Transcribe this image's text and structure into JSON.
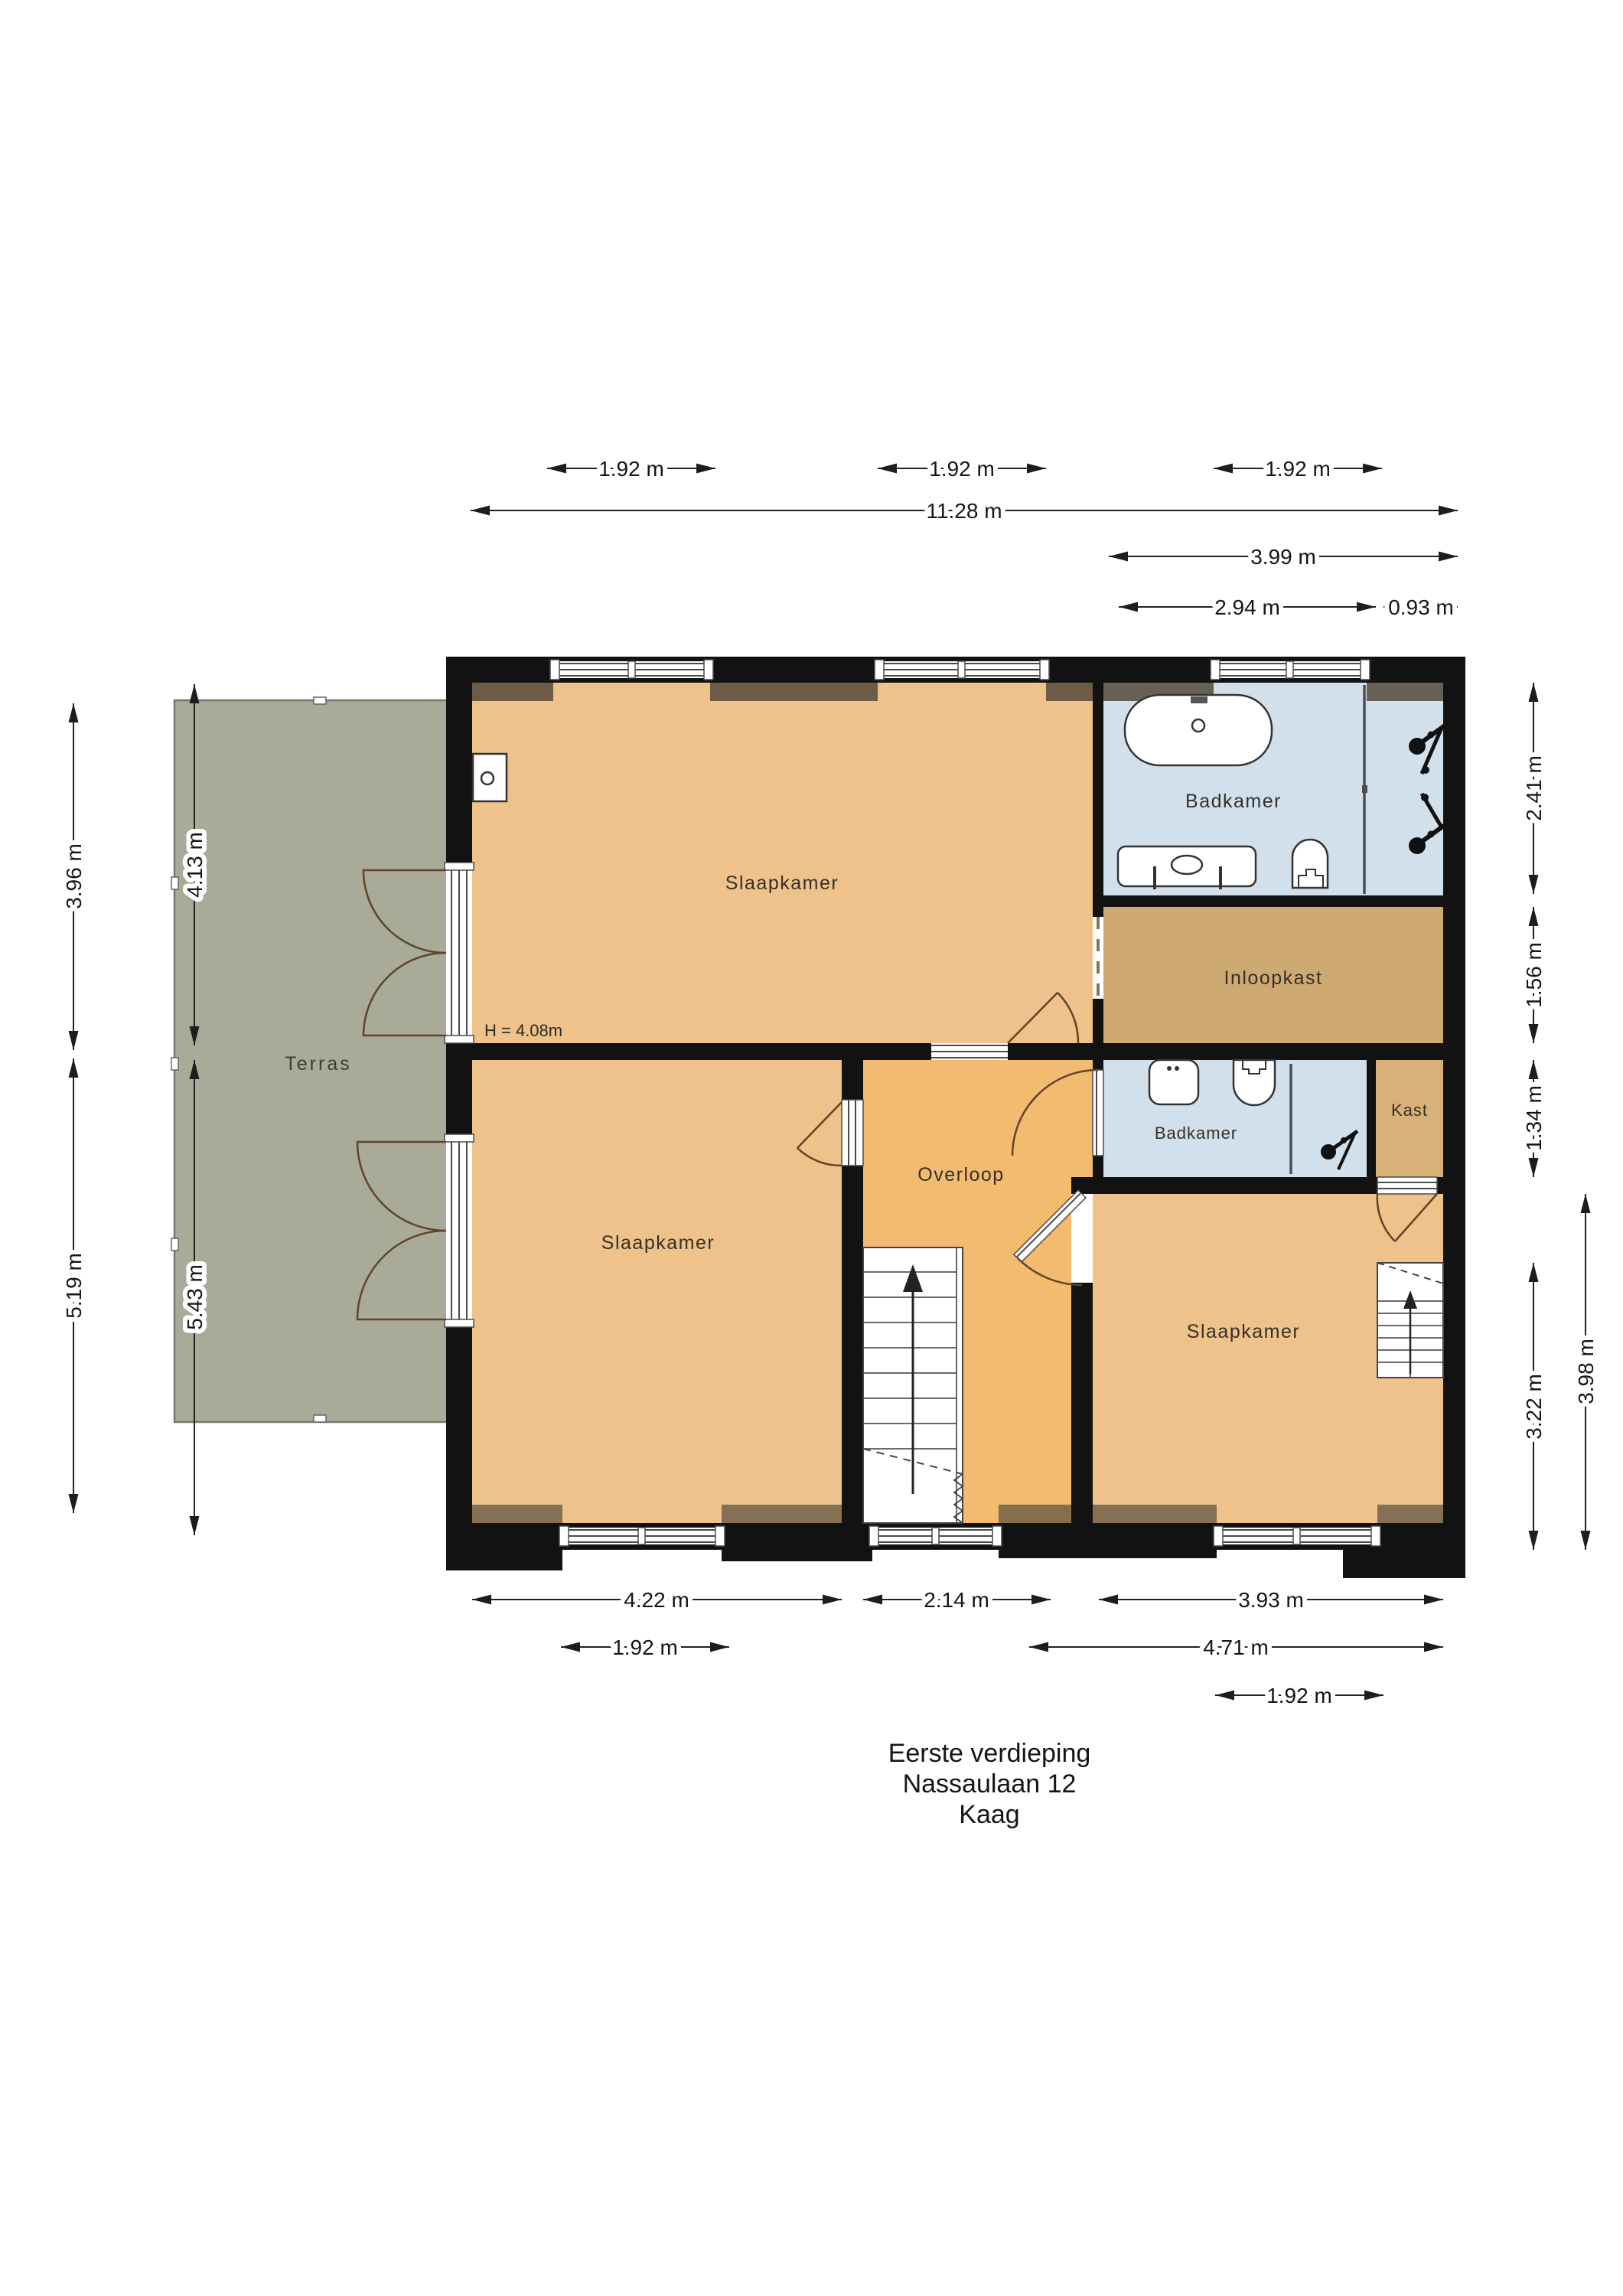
{
  "title": {
    "line1": "Eerste verdieping",
    "line2": "Nassaulaan 12",
    "line3": "Kaag"
  },
  "rooms": {
    "slaapkamer_top": "Slaapkamer",
    "badkamer_main": "Badkamer",
    "inloopkast": "Inloopkast",
    "badkamer_small": "Badkamer",
    "kast": "Kast",
    "overloop": "Overloop",
    "slaapkamer_left": "Slaapkamer",
    "slaapkamer_right": "Slaapkamer",
    "terras": "Terras",
    "height_note": "H = 4.08m"
  },
  "dimensions": {
    "top": [
      "1.92 m",
      "1.92 m",
      "1.92 m",
      "11.28 m",
      "3.99 m",
      "2.94 m",
      "0.93 m"
    ],
    "bottom": [
      "4.22 m",
      "2.14 m",
      "3.93 m",
      "1.92 m",
      "4.71 m",
      "1.92 m"
    ],
    "left": [
      "3.96 m",
      "4.13 m",
      "5.19 m",
      "5.43 m"
    ],
    "right": [
      "2.41 m",
      "1.56 m",
      "1.34 m",
      "3.22 m",
      "3.98 m"
    ]
  },
  "colors": {
    "bedroom_floor": "#eec28a",
    "landing_floor": "#f3bb70",
    "bathroom_floor": "#d2e0ec",
    "walkin_closet_floor": "#cfa972",
    "closet_floor": "#d8b178",
    "terrace_floor": "#a8ab97",
    "wall": "#121212",
    "stairs": "#ffffff"
  }
}
